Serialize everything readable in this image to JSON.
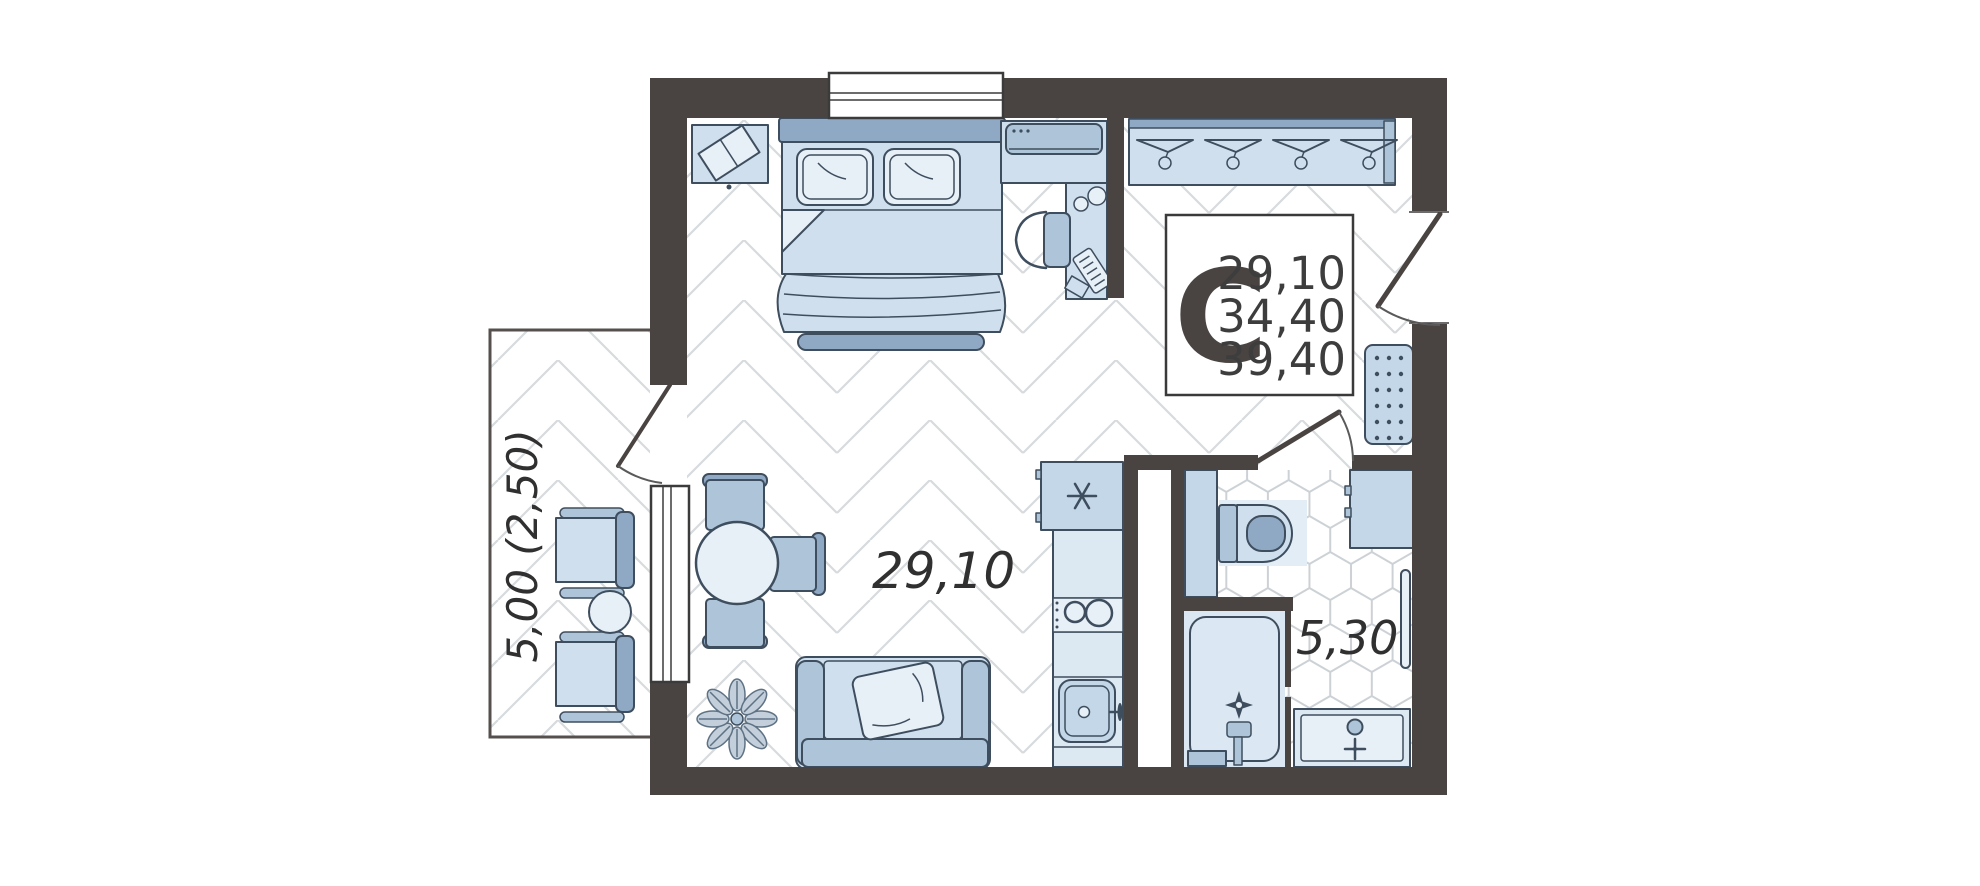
{
  "plan": {
    "title": "studio apartment floor plan",
    "rooms": {
      "living_room": {
        "area_label": "29,10"
      },
      "bathroom": {
        "area_label": "5,30"
      },
      "balcony": {
        "area_label": "5,00 (2,50)"
      }
    },
    "info_box": {
      "letter": "С",
      "living_area": "29,10",
      "apartment_area": "34,40",
      "total_area": "39,40"
    }
  },
  "colors": {
    "wall": "#494442",
    "outline": "#3e4e5e",
    "furniture_light": "#cfdfee",
    "furniture_mid": "#aec4d8",
    "furniture_dark": "#8fa9c4",
    "furniture_pale": "#e7eff7",
    "furniture_blue": "#c3d7e8",
    "counter": "#dce8f2",
    "floor_line": "#d7dbde",
    "hex_line": "#ccd1d5",
    "ink": "#323232"
  }
}
